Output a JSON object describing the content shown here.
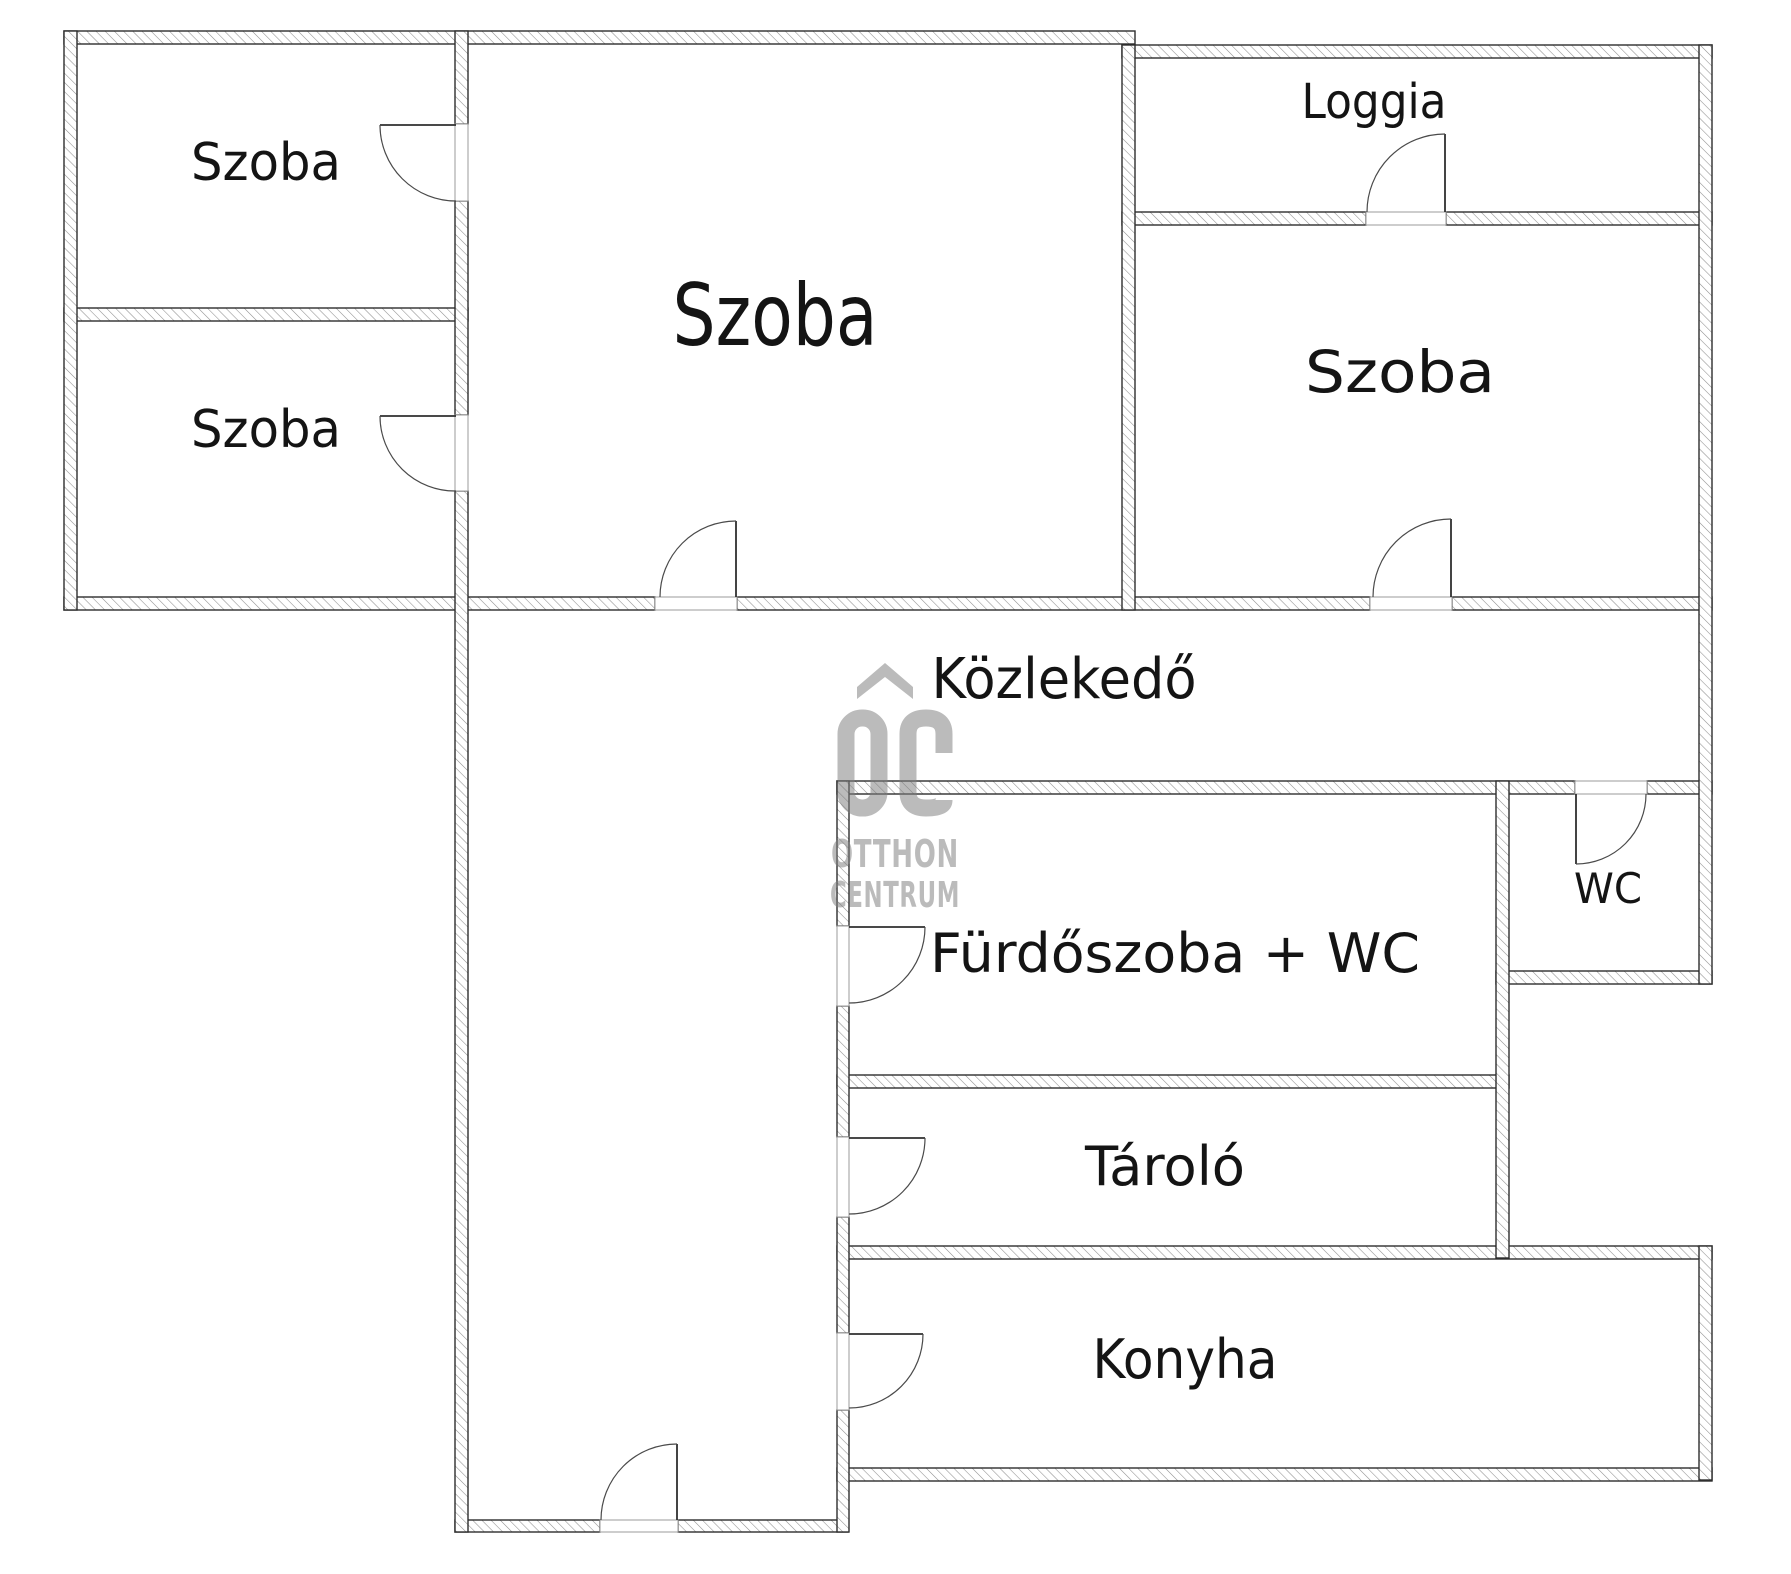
{
  "floorplan": {
    "background_color": "#ffffff",
    "wall_outline_color": "#2e2e2e",
    "hatch_color": "#8f8f8f",
    "label_color": "#141414",
    "rooms": {
      "szoba_top_left": {
        "label": "Szoba"
      },
      "szoba_bottom_left": {
        "label": "Szoba"
      },
      "szoba_center": {
        "label": "Szoba"
      },
      "loggia": {
        "label": "Loggia"
      },
      "szoba_right": {
        "label": "Szoba"
      },
      "kozlekedo": {
        "label": "Közlekedő"
      },
      "furdoszoba": {
        "label": "Fürdőszoba + WC"
      },
      "wc": {
        "label": "WC"
      },
      "tarolo": {
        "label": "Tároló"
      },
      "konyha": {
        "label": "Konyha"
      }
    },
    "watermark": {
      "monogram": "OC",
      "line1": "OTTHON",
      "line2": "CENTRUM",
      "color": "#bcbcbc"
    }
  }
}
